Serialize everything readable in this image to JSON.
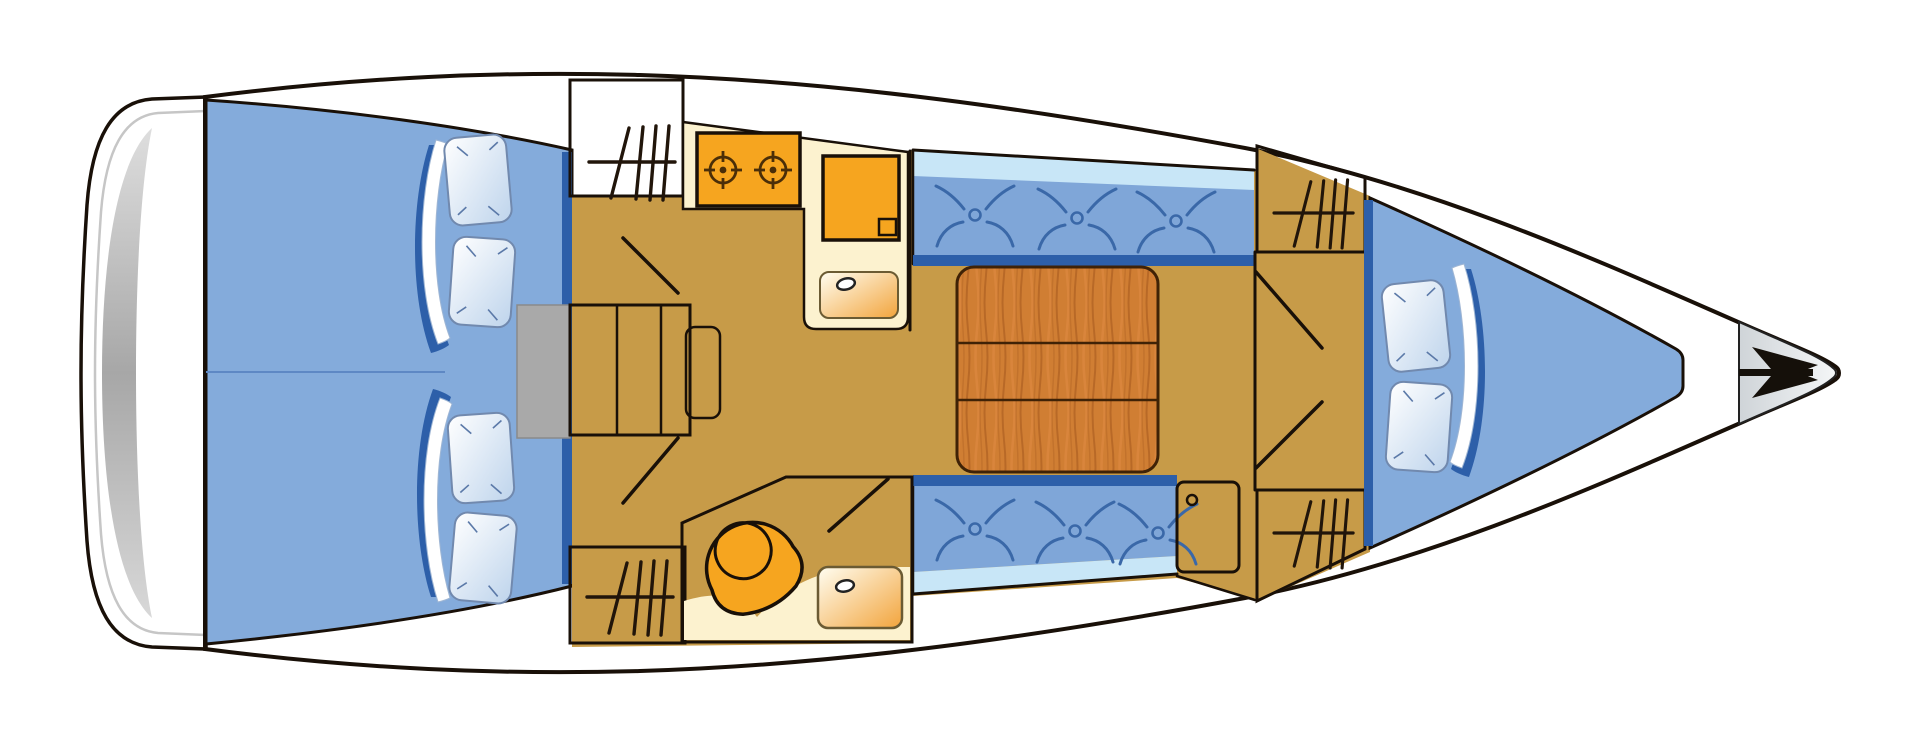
{
  "diagram": {
    "title": "Sailing yacht interior layout - top view floor plan",
    "type": "boat-floorplan",
    "orientation": {
      "stern": "left",
      "bow": "right"
    }
  },
  "colors": {
    "wood_base": "#c2661f",
    "wood_streak_dark": "#8c4310",
    "wood_streak_light": "#e08a44",
    "wood_light": "#d07e33",
    "floor_tan": "#c79b48",
    "counter_cream": "#fcf2cf",
    "appliance_orange": "#f6a51f",
    "cabin_blue": "#84abdb",
    "seat_blue": "#7fa6d8",
    "backrest_light_blue": "#c8e6f7",
    "edge_navy": "#2d5fa9",
    "motif_blue": "#3a68a8",
    "steps_gray": "#a9a9a9",
    "shower_base": "#dcab5c",
    "shower_dot": "#8f6522",
    "platform_white": "#ffffff",
    "platform_gray": "#ababab",
    "bow_gray": "#9aa3ab",
    "outline_black": "#191008",
    "anchor_black": "#15100a"
  },
  "areas": {
    "swim_platform": {
      "label": "Stern swim platform"
    },
    "aft_cabin": {
      "label": "Aft double cabin",
      "berths": 2,
      "pillows": 4,
      "blankets": 2
    },
    "companionway": {
      "label": "Companionway steps",
      "steps": 3,
      "engine_box": 1
    },
    "galley": {
      "label": "Galley",
      "stove_burners": 2,
      "items": [
        "two-burner stove",
        "top-loading fridge",
        "sink"
      ]
    },
    "salon": {
      "label": "Salon",
      "settees": 2,
      "cushion_motifs_per_settee": 3,
      "table_sections": 3,
      "items": [
        "folding table",
        "port settee",
        "starboard settee",
        "end cabinet"
      ]
    },
    "head": {
      "label": "Head / wet room",
      "items": [
        "marine toilet",
        "sink",
        "shower floor"
      ]
    },
    "forward_cabin": {
      "label": "Forward V-berth cabin",
      "pillows": 2,
      "blankets": 1,
      "wardrobes": 2
    },
    "wardrobes": {
      "label": "Hanging lockers",
      "count": 4
    },
    "bow": {
      "label": "Bow anchor locker"
    }
  },
  "icons": [
    "anchor-icon",
    "hanging-locker-icon",
    "stove-burner-icon",
    "cushion-motif-icon",
    "sink-drain-icon",
    "door-swing-icon"
  ]
}
